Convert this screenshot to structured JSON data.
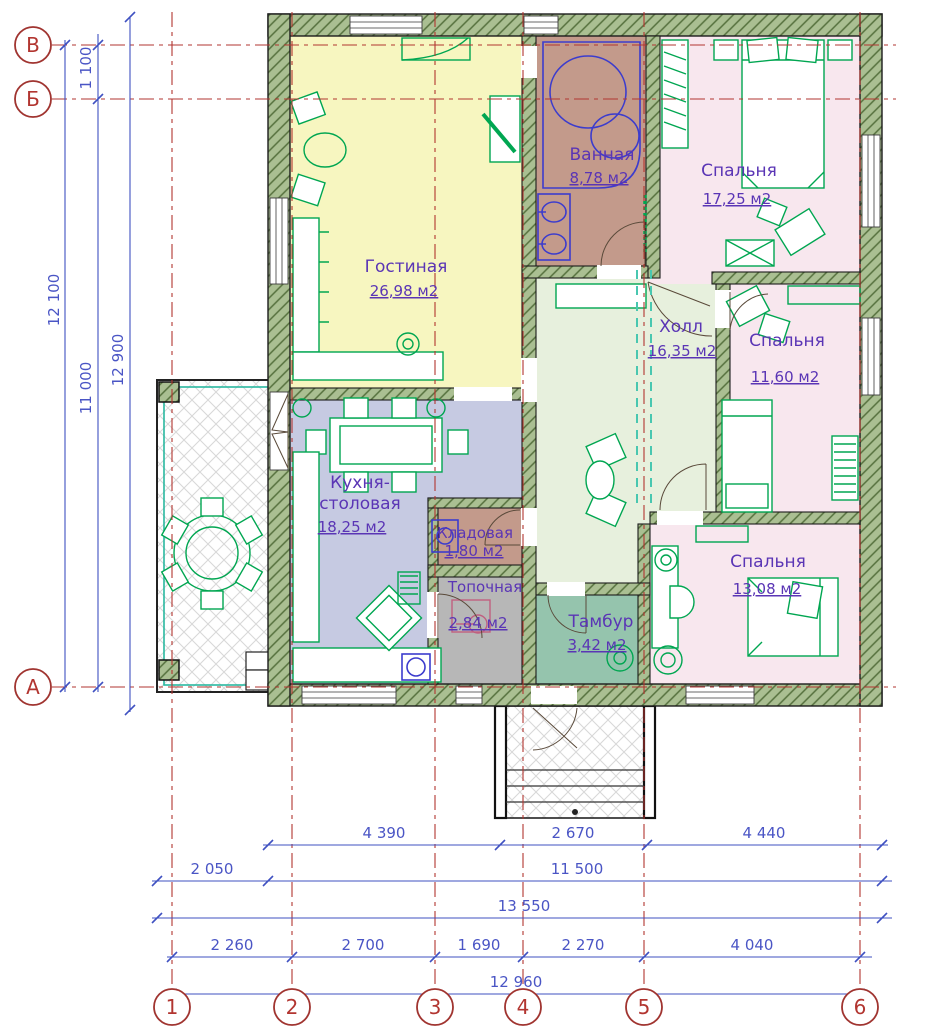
{
  "drawing": {
    "rooms": [
      {
        "id": "living",
        "name": "Гостиная",
        "area": "26,98 м2"
      },
      {
        "id": "bath",
        "name": "Ванная",
        "area": "8,78 м2"
      },
      {
        "id": "bedroom1",
        "name": "Спальня",
        "area": "17,25 м2"
      },
      {
        "id": "hall",
        "name": "Холл",
        "area": "16,35 м2"
      },
      {
        "id": "bedroom2",
        "name": "Спальня",
        "area": "11,60 м2"
      },
      {
        "id": "kitchen",
        "name": "Кухня-",
        "name2": "столовая",
        "area": "18,25 м2"
      },
      {
        "id": "pantry",
        "name": "Кладовая",
        "area": "1,80 м2"
      },
      {
        "id": "boiler",
        "name": "Топочная",
        "area": "2,84 м2"
      },
      {
        "id": "vestibule",
        "name": "Тамбур",
        "area": "3,42 м2"
      },
      {
        "id": "bedroom3",
        "name": "Спальня",
        "area": "13,08 м2"
      }
    ],
    "axis_rows": [
      "В",
      "Б",
      "А"
    ],
    "axis_cols": [
      "1",
      "2",
      "3",
      "4",
      "5",
      "6"
    ],
    "dims_left": [
      "12 100",
      "1 100",
      "11 000",
      "12 900"
    ],
    "dims_bottom": {
      "row1": [
        "4 390",
        "2 670",
        "4 440"
      ],
      "row2": [
        "2 050",
        "11 500"
      ],
      "row3": [
        "13 550"
      ],
      "row4": [
        "2 260",
        "2 700",
        "1 690",
        "2 270",
        "4 040"
      ],
      "row5": [
        "12 960"
      ]
    },
    "colors": {
      "wall_fill": "#aabf92",
      "wall_hatch": "#55703d",
      "living": "#f7f6c0",
      "bath": "#c39a8b",
      "bedroom": "#f8e7ee",
      "hall": "#e7f0dd",
      "kitchen": "#c6cae2",
      "pantry": "#c39a8b",
      "boiler": "#b7b7b7",
      "vestibule": "#95c4ad",
      "furniture": "#00a651",
      "plumbing": "#3c3ccd",
      "dimension": "#3f51c1",
      "axis": "#b23530",
      "label": "#5a35b5",
      "terrace_line": "#2ab8a0"
    }
  }
}
